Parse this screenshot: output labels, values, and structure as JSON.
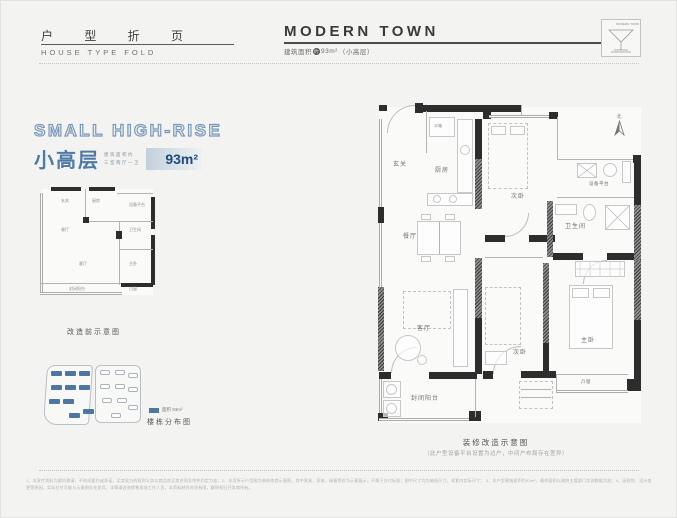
{
  "header": {
    "section_title_cn": "户 型 折 页",
    "section_title_en": "HOUSE  TYPE  FOLD",
    "brand": "MODERN TOWN",
    "area_prefix": "建筑面积",
    "area_approx": "约",
    "area_value": "93m²",
    "area_suffix": "（小高层）",
    "logo_text": "MODERN TOWN"
  },
  "hero": {
    "title_en": "SMALL HIGH-RISE",
    "title_cn": "小高层",
    "spec_line1": "建筑面积约",
    "spec_line2": "三室两厅一卫",
    "area": "93m²"
  },
  "before_plan": {
    "caption": "改造前示意图",
    "rooms": [
      "玄关",
      "厨房",
      "设备平台",
      "餐厅",
      "卫生间",
      "客厅",
      "主卧",
      "凸窗",
      "封闭阳台"
    ]
  },
  "site_map": {
    "legend_label": "面积 93m²",
    "caption": "楼栋分布图"
  },
  "main_plan": {
    "caption": "装修改造示意图",
    "note": "（此户型设备平台设置为边户，中间户布局存在差异）",
    "north_label": "北",
    "rooms": {
      "entry": "玄关",
      "water_tank": "水箱",
      "kitchen": "厨房",
      "dining": "餐厅",
      "bedroom_top": "次卧",
      "equipment": "设备平台",
      "bathroom": "卫生间",
      "living": "客厅",
      "bedroom_mid": "次卧",
      "master": "主卧",
      "bay_window": "凸窗",
      "balcony": "封闭阳台"
    }
  },
  "footer": {
    "disclaimer_line1": "1、本宣传资料为要约邀请，不构成要约或承诺，买卖双方的权利义务以商品房买卖合同及附件约定为准；2、本页所示户型图为装修改造示意图，其中家具、家电、绿植等仅为示意展示，不属于交付标准；图中尺寸均为轴线尺寸，非套内实际尺寸；",
    "disclaimer_line2": "3、本户型建筑面积约93m²，最终面积以政府主管部门实测数据为准；4、因规划、设计变更等原因，实际交付可能与示意图存在差异，详情请咨询销售现场工作人员，本资料制作时间有限，解释权归开发商所有。"
  }
}
